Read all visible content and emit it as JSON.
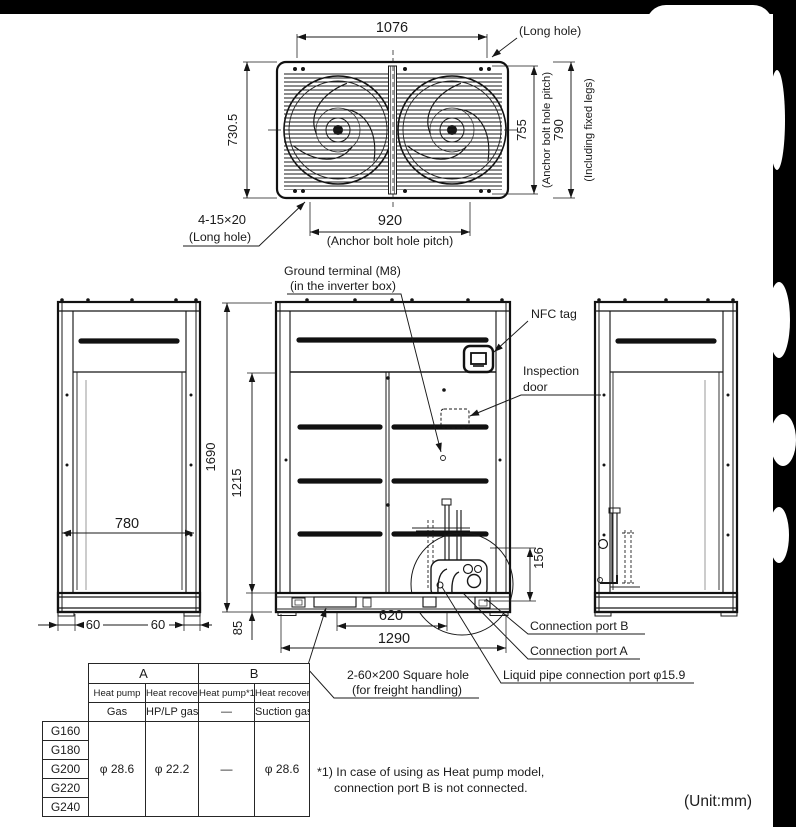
{
  "colors": {
    "background": "#000000",
    "paper": "#ffffff",
    "line": "#1a1a1a"
  },
  "unit_note": "(Unit:mm)",
  "top_view": {
    "dim_width": "1076",
    "long_hole_top": "(Long hole)",
    "dim_depth": "730.5",
    "dim_anchor_pitch_vertical": "755",
    "anchor_pitch_vertical_label": "(Anchor bolt hole pitch)",
    "dim_including_legs": "790",
    "including_legs_label": "(Including fixed legs)",
    "bolt_hole_spec": "4-15×20",
    "long_hole_bottom": "(Long hole)",
    "dim_anchor_pitch_horizontal": "920",
    "anchor_pitch_horizontal_label": "(Anchor bolt hole pitch)"
  },
  "front_view": {
    "ground_terminal_label_1": "Ground terminal (M8)",
    "ground_terminal_label_2": "(in the inverter box)",
    "nfc_tag_label": "NFC tag",
    "inspection_door_label_1": "Inspection",
    "inspection_door_label_2": "door",
    "dim_height": "1690",
    "dim_side_panel_height": "1215",
    "dim_depth": "780",
    "dim_leg_left": "60",
    "dim_leg_right": "60",
    "dim_base_height": "85",
    "dim_port_height": "156",
    "dim_square_hole_pitch": "620",
    "dim_port_offset": "1290",
    "square_hole_label_1": "2-60×200 Square hole",
    "square_hole_label_2": "(for freight handling)",
    "connection_port_b_label": "Connection port B",
    "connection_port_a_label": "Connection port A",
    "liquid_pipe_label": "Liquid pipe connection port φ15.9"
  },
  "pipe_table": {
    "group_a": "A",
    "group_b": "B",
    "headers": [
      "Heat pump",
      "Heat recovery",
      "Heat pump*1)",
      "Heat recovery"
    ],
    "pipe_types": [
      "Gas",
      "HP/LP gas",
      "—",
      "Suction gas"
    ],
    "models": [
      "G160",
      "G180",
      "G200",
      "G220",
      "G240"
    ],
    "values": [
      "φ 28.6",
      "φ 22.2",
      "—",
      "φ 28.6"
    ]
  },
  "footnote": {
    "line_1": "*1) In case of using as Heat pump model,",
    "line_2": "connection port B is not connected."
  }
}
